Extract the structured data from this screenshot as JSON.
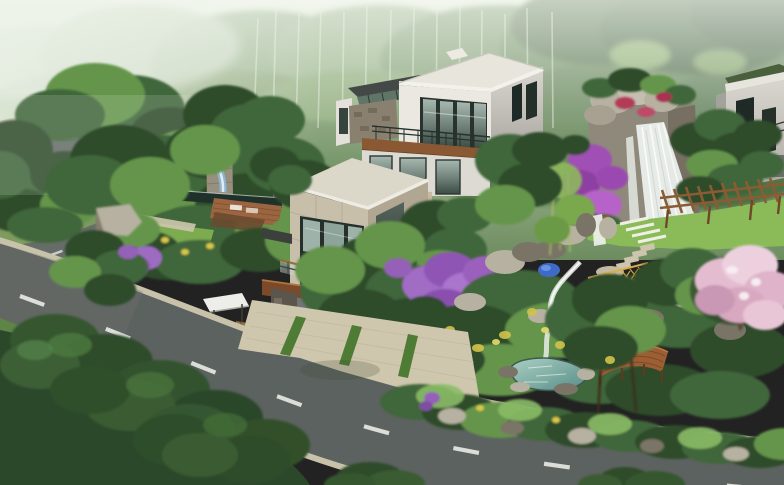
{
  "meta": {
    "type": "architectural-rendering",
    "subject": "Hillside modern villa with landscaped water garden beside a curving road",
    "view": "aerial three-quarter perspective"
  },
  "scene": {
    "background": "misty forested hillside with birch trunks",
    "road": "curved asphalt road with beige curbs and white dashed center line, hairpin bend at upper left",
    "buildings": [
      "white flat-roof villa block with window band and balcony",
      "stone-tiled cube with corner glass window",
      "garage level with white paneled door and stone pillar",
      "entrance canopy with lattice gate",
      "neighboring villa partially visible at right edge"
    ],
    "water_features": [
      "large rock waterfall",
      "garden cascade slide into reflecting pool",
      "stream with small falls",
      "teal pond"
    ],
    "vegetation": [
      "dark foreground tree canopies",
      "lawns",
      "purple blossom trees",
      "pink blossom tree",
      "bougainvillea on waterfall rocks",
      "topiary cloud pines",
      "bamboo clump",
      "roadside shrubs with yellow flowers"
    ],
    "structures": [
      "wood pergola on lawn",
      "timber deck bridge at pond",
      "orange lattice garden fence",
      "balcony and terrace railings",
      "stone step path",
      "driveway apron with grass strips"
    ]
  },
  "palette": {
    "fog_light": "#eef3ea",
    "forest_light": "#9fb892",
    "forest_mid": "#6d8c62",
    "forest_dark": "#46663f",
    "canopy_dark": "#2e4c2c",
    "canopy_mid": "#40663a",
    "canopy_bright": "#65954c",
    "canopy_light": "#8abb66",
    "lawn": "#7cab50",
    "lawn_bright": "#8bbb58",
    "asphalt": "#5c625f",
    "curb": "#c9c2ab",
    "lane_mark": "#e6e8e3",
    "wall_white": "#eae8e1",
    "roof_light": "#e7e5dc",
    "stone_tile": "#c8bfab",
    "window_frame": "#27322d",
    "glass_light": "#a4b6ae",
    "glass_dark": "#33433c",
    "wood": "#8a5832",
    "wood_dark": "#69401f",
    "deck_red": "#9c5e33",
    "rock_light": "#b7b1a1",
    "rock_shadow": "#7a7466",
    "water_teal": "#6fa49a",
    "waterfall_white": "#f2f5f1",
    "flower_purple": "#a05cb4",
    "flower_pink": "#e3bcd0",
    "flower_red": "#b23a55",
    "flower_yellow": "#d9c84a",
    "fence_yellow": "#cfa23e",
    "pool_dark": "#20302b",
    "slide_blue": "#8fb4d0",
    "tarp_blue": "#3f6bc8"
  }
}
